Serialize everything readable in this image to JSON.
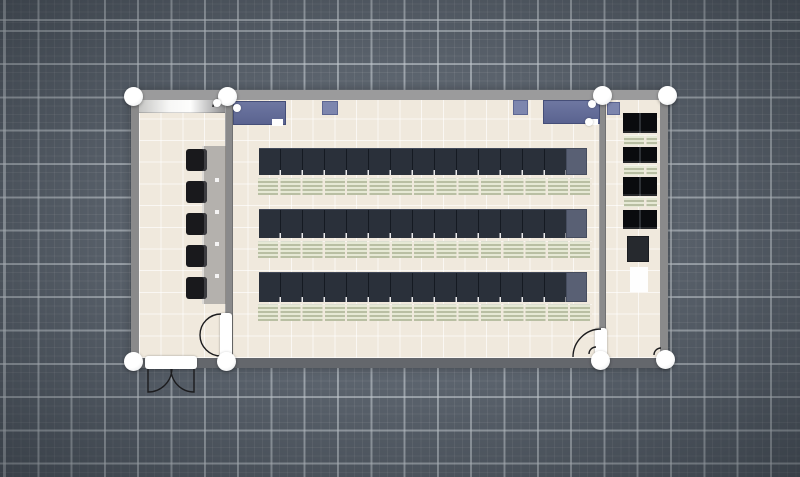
{
  "scene": {
    "type": "floor-plan-editor-canvas",
    "description": "Top-down classroom floor plan selected for editing, with white wall-endpoint selection handles",
    "rooms": [
      "left-room",
      "main-classroom",
      "right-room"
    ]
  },
  "colors": {
    "bg": "#5b636d",
    "grid_major": "rgba(206,212,218,0.55)",
    "grid_minor": "rgba(255,255,255,0.07)",
    "wall": "#8a8a8b",
    "wall_light": "#9b9b9c",
    "wall_dark": "#64676c",
    "floor": "#f0e9dd",
    "tile_line": "rgba(255,255,255,0.65)",
    "desk": "#2a303a",
    "desk_end": "#596074",
    "kb_a": "#e6e9d5",
    "kb_b": "#b9bfa3",
    "blue_desk": "#626b96",
    "blue_light": "#7d86ae",
    "counter": "#b4b1ad",
    "chair": "#19191c",
    "cabinet": "#26292e",
    "stroke": "#1c1c1e"
  },
  "objects": [
    {
      "name": "building-walls",
      "cls": "building",
      "x": 131,
      "y": 90,
      "w": 537,
      "h": 278,
      "it": false
    },
    {
      "name": "floor-tiles",
      "cls": "floor",
      "x": 139,
      "y": 100,
      "w": 521,
      "h": 258,
      "it": true
    },
    {
      "name": "divider-wall-left",
      "cls": "wall",
      "x": 225,
      "y": 100,
      "w": 8,
      "h": 258,
      "it": true
    },
    {
      "name": "divider-wall-right",
      "cls": "wall",
      "x": 599,
      "y": 100,
      "w": 7,
      "h": 258,
      "it": true
    },
    {
      "name": "whiteboard-counter",
      "cls": "whiteboard",
      "x": 139,
      "y": 100,
      "w": 86,
      "h": 13,
      "it": true
    },
    {
      "name": "wall-counter",
      "cls": "counter",
      "x": 202,
      "y": 146,
      "w": 24,
      "h": 158,
      "it": true
    },
    {
      "name": "stool-1",
      "cls": "chair",
      "x": 186,
      "y": 149,
      "w": 21,
      "h": 22,
      "it": true
    },
    {
      "name": "stool-2",
      "cls": "chair",
      "x": 186,
      "y": 181,
      "w": 21,
      "h": 22,
      "it": true
    },
    {
      "name": "stool-3",
      "cls": "chair",
      "x": 186,
      "y": 213,
      "w": 21,
      "h": 22,
      "it": true
    },
    {
      "name": "stool-4",
      "cls": "chair",
      "x": 186,
      "y": 245,
      "w": 21,
      "h": 22,
      "it": true
    },
    {
      "name": "stool-5",
      "cls": "chair",
      "x": 186,
      "y": 277,
      "w": 21,
      "h": 22,
      "it": true
    },
    {
      "name": "teacher-desk-left",
      "cls": "desk-blue",
      "x": 233,
      "y": 101,
      "w": 53,
      "h": 24,
      "it": true
    },
    {
      "name": "teacher-chair-left",
      "cls": "rug-white",
      "x": 272,
      "y": 119,
      "w": 11,
      "h": 7,
      "it": true
    },
    {
      "name": "side-table-1",
      "cls": "side-table",
      "x": 322,
      "y": 101,
      "w": 16,
      "h": 14,
      "it": true
    },
    {
      "name": "side-table-2",
      "cls": "side-table",
      "x": 513,
      "y": 100,
      "w": 15,
      "h": 15,
      "it": true
    },
    {
      "name": "teacher-desk-right",
      "cls": "desk-blue",
      "x": 543,
      "y": 100,
      "w": 57,
      "h": 24,
      "it": true
    },
    {
      "name": "teacher-chair-right",
      "cls": "rug-white",
      "x": 587,
      "y": 119,
      "w": 11,
      "h": 6,
      "it": true
    },
    {
      "name": "desk-row-1",
      "cls": "desk-row",
      "x": 259,
      "y": 148,
      "w": 308,
      "h": 27,
      "it": true
    },
    {
      "name": "desk-row-1-end",
      "cls": "desk-end",
      "x": 566,
      "y": 148,
      "w": 21,
      "h": 27,
      "it": true
    },
    {
      "name": "bench-row-1",
      "cls": "kb-row",
      "x": 258,
      "y": 178,
      "w": 334,
      "h": 17,
      "it": true
    },
    {
      "name": "desk-row-2",
      "cls": "desk-row",
      "x": 259,
      "y": 209,
      "w": 308,
      "h": 29,
      "it": true
    },
    {
      "name": "desk-row-2-end",
      "cls": "desk-end",
      "x": 566,
      "y": 209,
      "w": 21,
      "h": 29,
      "it": true
    },
    {
      "name": "bench-row-2",
      "cls": "kb-row",
      "x": 258,
      "y": 241,
      "w": 334,
      "h": 17,
      "it": true
    },
    {
      "name": "desk-row-3",
      "cls": "desk-row",
      "x": 259,
      "y": 272,
      "w": 308,
      "h": 30,
      "it": true
    },
    {
      "name": "desk-row-3-end",
      "cls": "desk-end",
      "x": 566,
      "y": 272,
      "w": 21,
      "h": 30,
      "it": true
    },
    {
      "name": "bench-row-3",
      "cls": "kb-row",
      "x": 258,
      "y": 304,
      "w": 334,
      "h": 17,
      "it": true
    },
    {
      "name": "side-table-3",
      "cls": "side-table",
      "x": 607,
      "y": 102,
      "w": 13,
      "h": 13,
      "it": true
    },
    {
      "name": "black-desk-pair-1",
      "cls": "desk-black",
      "x": 623,
      "y": 113,
      "w": 34,
      "h": 20,
      "it": true
    },
    {
      "name": "bench-r-1",
      "cls": "kb-row",
      "x": 624,
      "y": 135,
      "w": 33,
      "h": 10,
      "it": true
    },
    {
      "name": "black-desk-pair-2",
      "cls": "desk-black",
      "x": 623,
      "y": 147,
      "w": 34,
      "h": 16,
      "it": true
    },
    {
      "name": "bench-r-2",
      "cls": "kb-row",
      "x": 624,
      "y": 165,
      "w": 33,
      "h": 10,
      "it": true
    },
    {
      "name": "black-desk-pair-3",
      "cls": "desk-black",
      "x": 623,
      "y": 177,
      "w": 34,
      "h": 19,
      "it": true
    },
    {
      "name": "bench-r-3",
      "cls": "kb-row",
      "x": 624,
      "y": 197,
      "w": 33,
      "h": 10,
      "it": true
    },
    {
      "name": "black-desk-pair-4",
      "cls": "desk-black",
      "x": 623,
      "y": 210,
      "w": 34,
      "h": 19,
      "it": true
    },
    {
      "name": "cabinet",
      "cls": "cabinet",
      "x": 627,
      "y": 236,
      "w": 22,
      "h": 26,
      "it": true
    },
    {
      "name": "white-rug",
      "cls": "rug-white",
      "x": 630,
      "y": 267,
      "w": 18,
      "h": 25,
      "it": true
    },
    {
      "name": "exterior-double-door",
      "cls": "door-leaf",
      "x": 145,
      "y": 356,
      "w": 52,
      "h": 13,
      "it": true
    },
    {
      "name": "interior-door-left",
      "cls": "door-leaf",
      "x": 220,
      "y": 313,
      "w": 12,
      "h": 45,
      "it": true
    },
    {
      "name": "interior-door-right",
      "cls": "door-leaf",
      "x": 595,
      "y": 328,
      "w": 12,
      "h": 33,
      "it": true
    }
  ],
  "door_swings": {
    "paths": [
      "M148 369 L148 392 A24 24 0 0 0 172 369",
      "M194 369 L194 392 A23 23 0 0 1 171 369",
      "M221 314 A21 21 0 0 0 200 335 A21 21 0 0 0 221 356",
      "M573 357 A28 28 0 0 1 601 329",
      "M589 354 A7 7 0 0 1 596 347",
      "M654 355 A7 7 0 0 1 661 348",
      "M213 107 A8 8 0 0 1 221 99"
    ]
  },
  "selection_handles": [
    {
      "x": 133,
      "y": 96
    },
    {
      "x": 227,
      "y": 96
    },
    {
      "x": 602,
      "y": 95
    },
    {
      "x": 667,
      "y": 95
    },
    {
      "x": 133,
      "y": 361
    },
    {
      "x": 226,
      "y": 361
    },
    {
      "x": 600,
      "y": 360
    },
    {
      "x": 665,
      "y": 359
    }
  ],
  "object_dots": [
    {
      "x": 237,
      "y": 108
    },
    {
      "x": 592,
      "y": 104
    },
    {
      "x": 589,
      "y": 122
    },
    {
      "x": 217,
      "y": 103
    }
  ]
}
